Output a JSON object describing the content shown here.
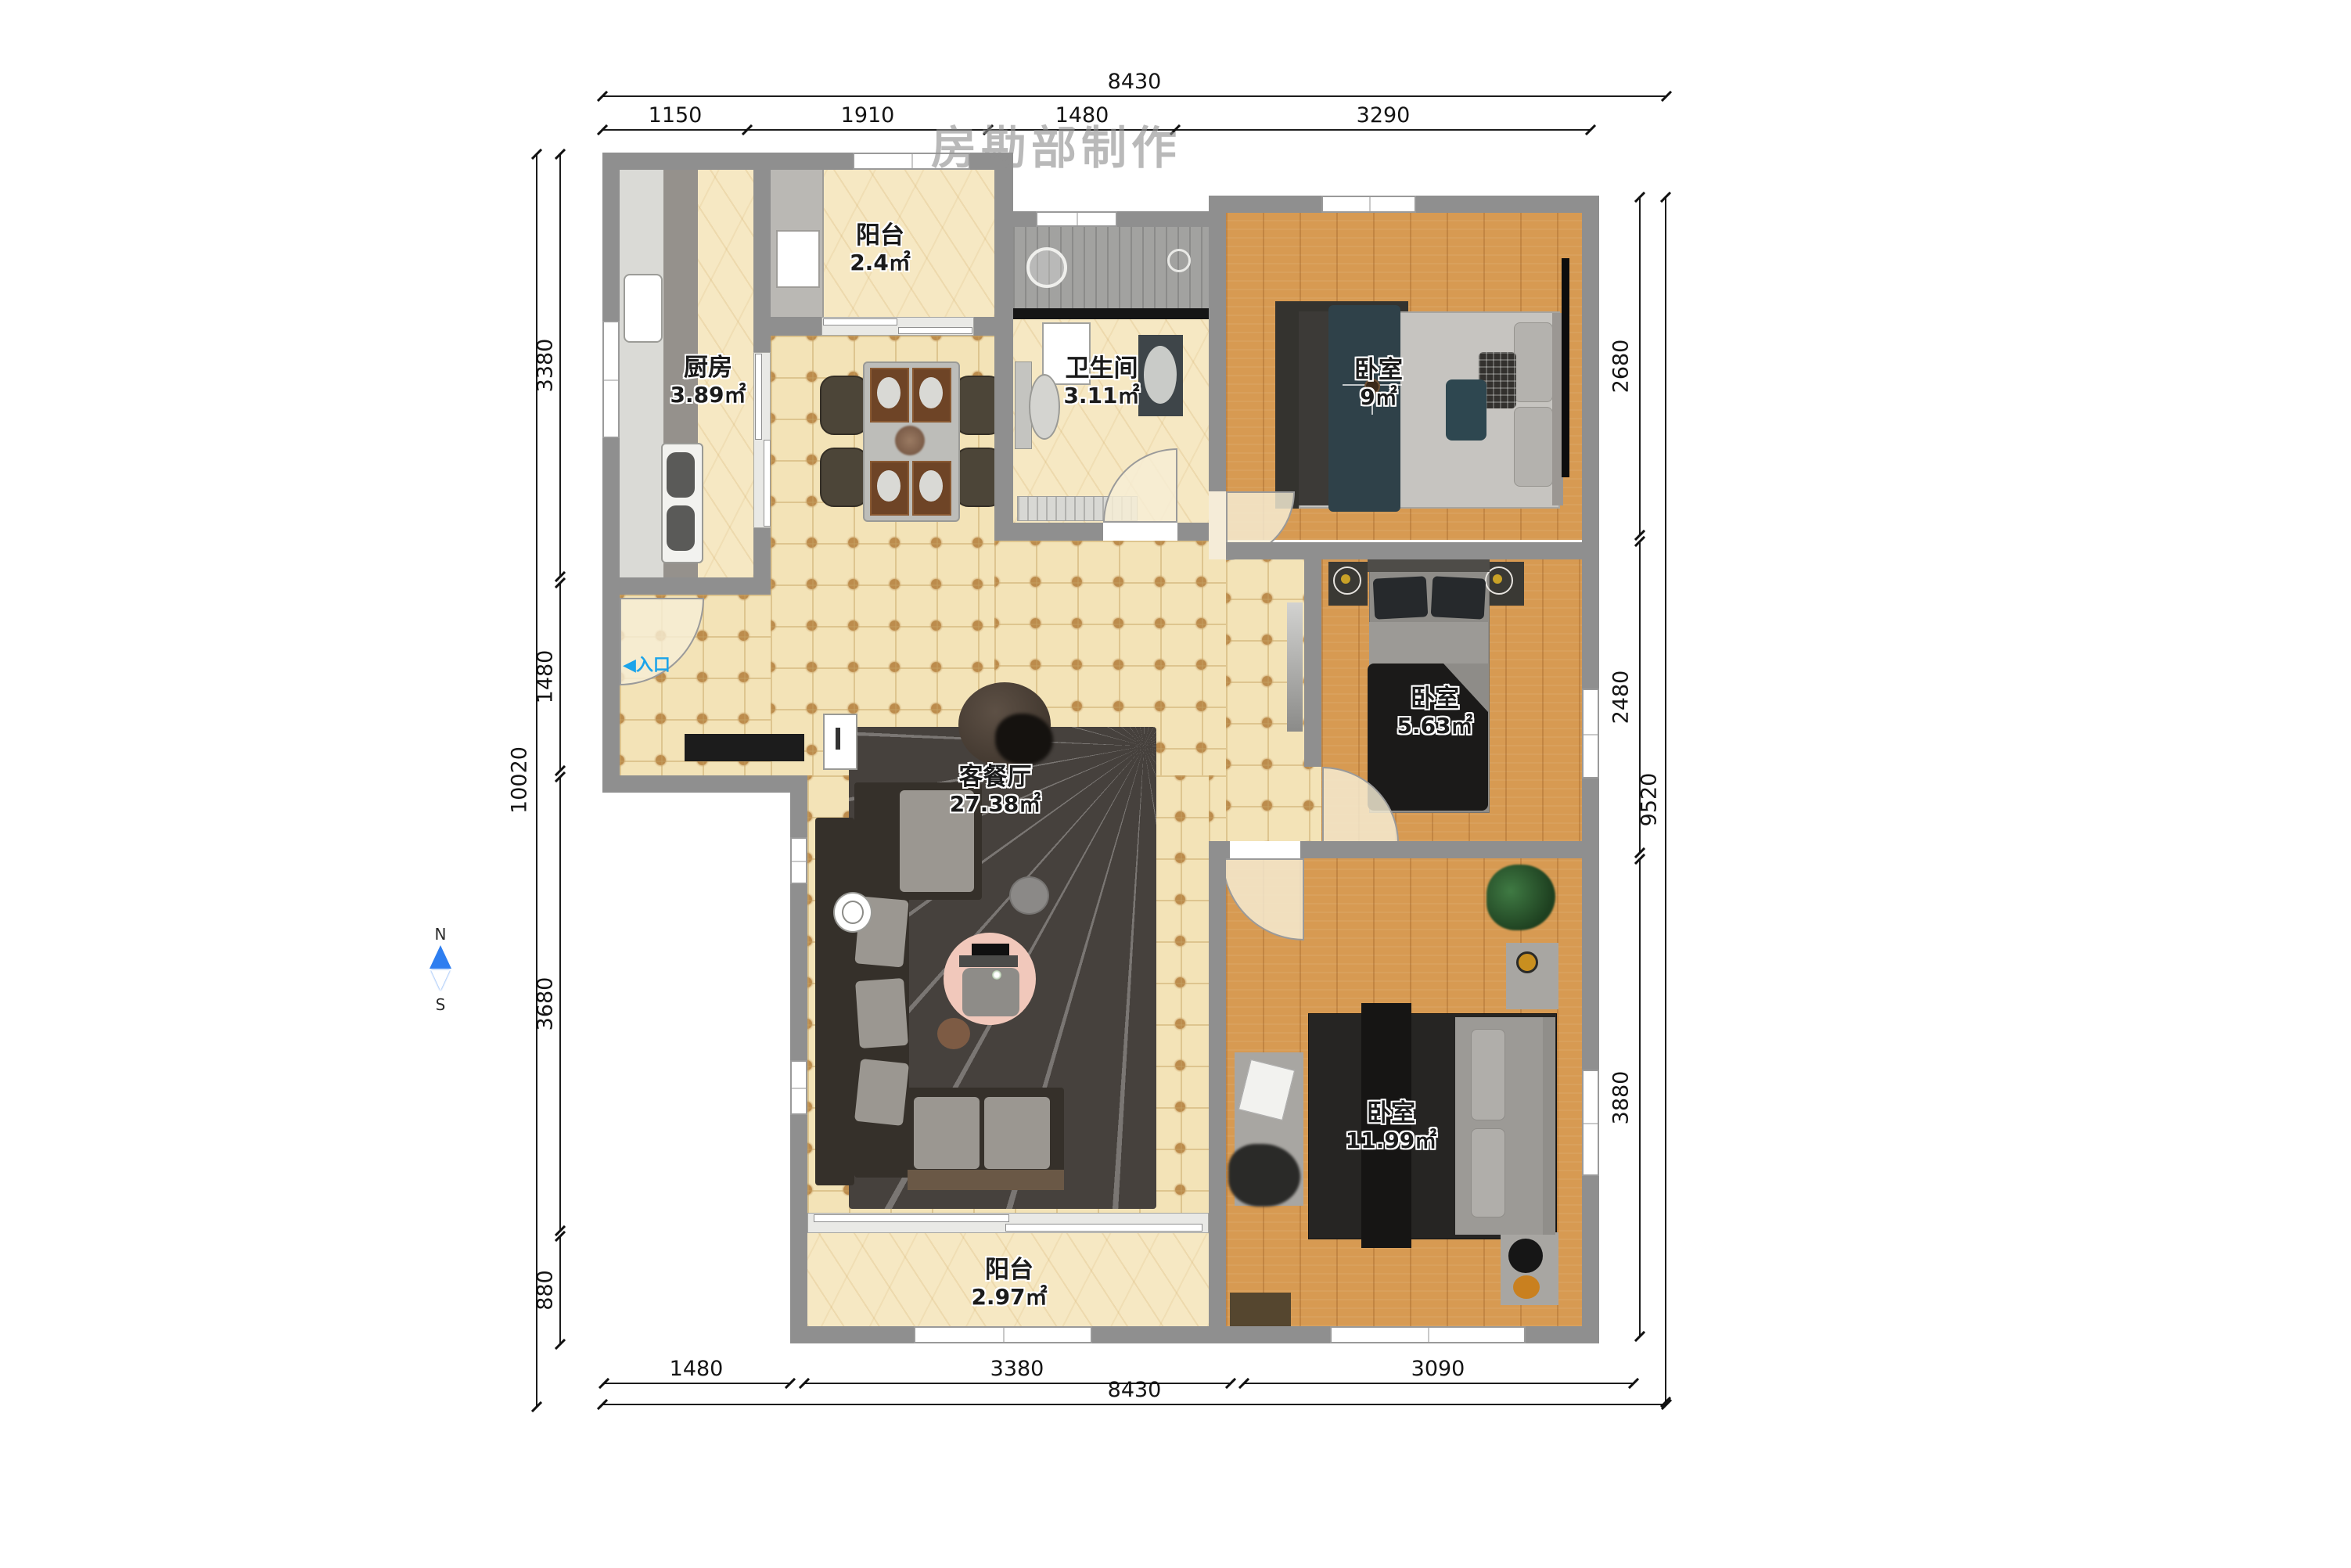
{
  "watermark": "房勘部制作",
  "compass": {
    "north": "N",
    "south": "S"
  },
  "entrance": {
    "arrow": "◀",
    "label": "入口"
  },
  "rooms": {
    "balcony_top": {
      "name": "阳台",
      "area": "2.4㎡"
    },
    "kitchen": {
      "name": "厨房",
      "area": "3.89㎡"
    },
    "bathroom": {
      "name": "卫生间",
      "area": "3.11㎡"
    },
    "bedroom_top": {
      "name": "卧室",
      "area": "9㎡"
    },
    "bedroom_mid": {
      "name": "卧室",
      "area": "5.63㎡"
    },
    "living": {
      "name": "客餐厅",
      "area": "27.38㎡"
    },
    "bedroom_bottom": {
      "name": "卧室",
      "area": "11.99㎡"
    },
    "balcony_bottom": {
      "name": "阳台",
      "area": "2.97㎡"
    }
  },
  "dimensions": {
    "top": {
      "total": "8430",
      "segments": [
        "1150",
        "1910",
        "1480",
        "3290"
      ]
    },
    "bottom": {
      "total": "8430",
      "segments": [
        "1480",
        "3380",
        "3090"
      ]
    },
    "left": {
      "total": "10020",
      "segments": [
        "3380",
        "1480",
        "3680",
        "880"
      ]
    },
    "right": {
      "total": "9520",
      "segments": [
        "2680",
        "2480",
        "3880"
      ]
    }
  },
  "colors": {
    "wall": "#8f8f8f",
    "tile": "#f3e3b7",
    "marble": "#f6e8c3",
    "wood": "#d79a52",
    "rug": "#46413d",
    "entrance_blue": "#1ba4ea",
    "pink_rug": "#f1c8bb",
    "compass_blue": "#2e7ef0"
  }
}
